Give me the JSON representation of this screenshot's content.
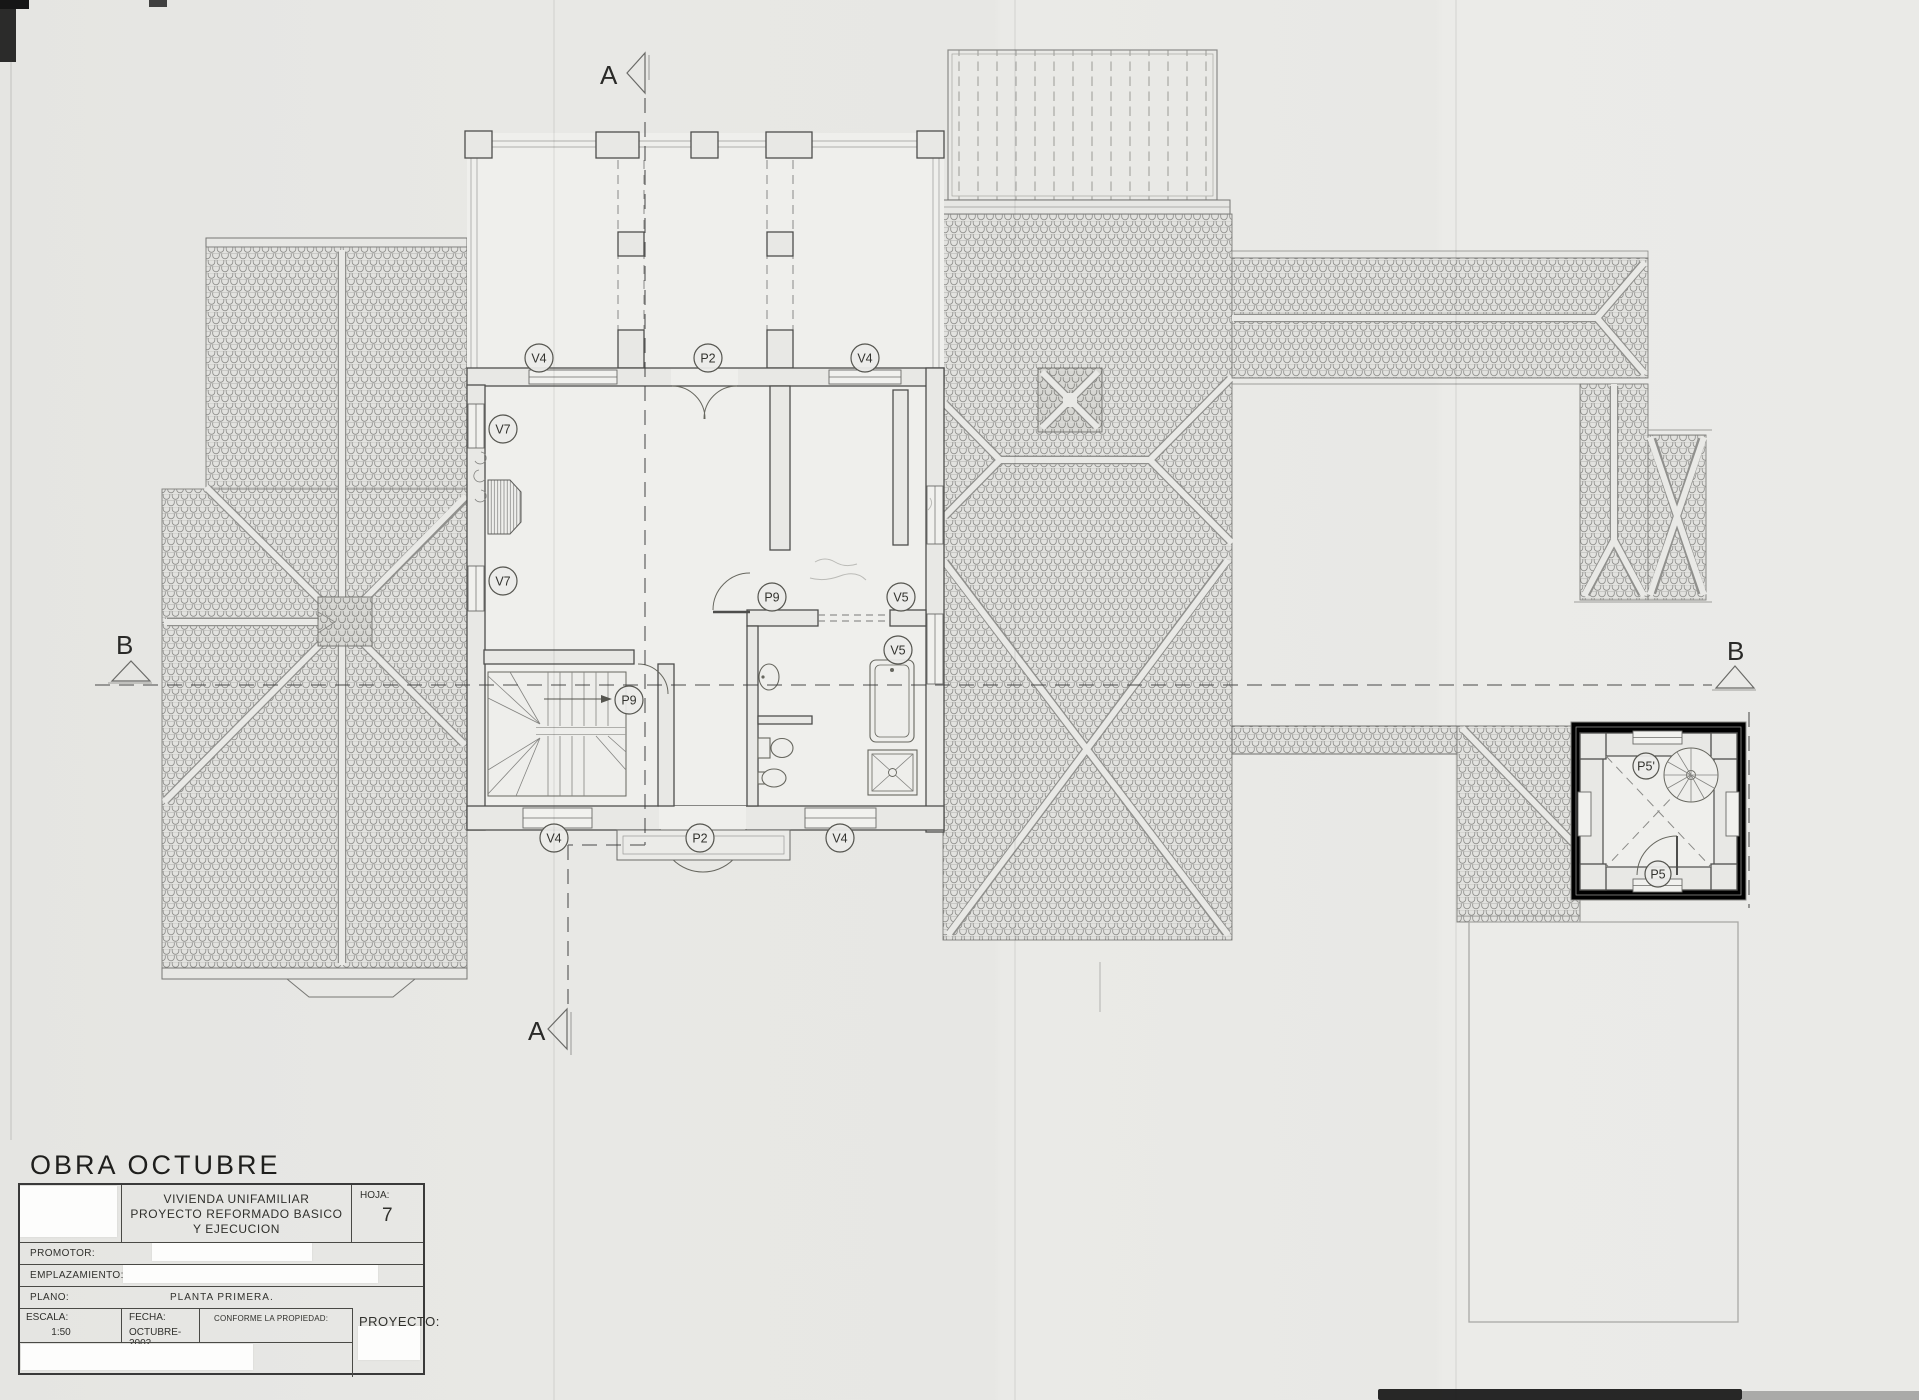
{
  "sheet": {
    "project_name": "OBRA OCTUBRE",
    "work_title_line1": "VIVIENDA UNIFAMILIAR",
    "work_title_line2": "PROYECTO REFORMADO BASICO",
    "work_title_line3": "Y EJECUCION",
    "sheet_label": "HOJA:",
    "sheet_number": "7",
    "promoter_label": "PROMOTOR:",
    "location_label": "EMPLAZAMIENTO:",
    "plan_label": "PLANO:",
    "plan_name": "PLANTA PRIMERA.",
    "scale_label": "ESCALA:",
    "scale_value": "1:50",
    "date_label": "FECHA:",
    "date_value": "OCTUBRE-2002",
    "approval_label": "CONFORME LA PROPIEDAD:",
    "project_label": "PROYECTO:"
  },
  "section_markers": {
    "a_top": "A",
    "a_bottom": "A",
    "b_left": "B",
    "b_right": "B"
  },
  "tags": {
    "terrace_window_left": "V4",
    "terrace_door": "P2",
    "terrace_window_right": "V4",
    "west_window_upper": "V7",
    "west_window_lower": "V7",
    "hall_door": "P9",
    "bedroom_window": "V5",
    "bathroom_window": "V5",
    "stair_door": "P9",
    "south_window_left": "V4",
    "south_door": "P2",
    "south_window_right": "V4",
    "tower_upper_door": "P5'",
    "tower_lower_door": "P5"
  }
}
